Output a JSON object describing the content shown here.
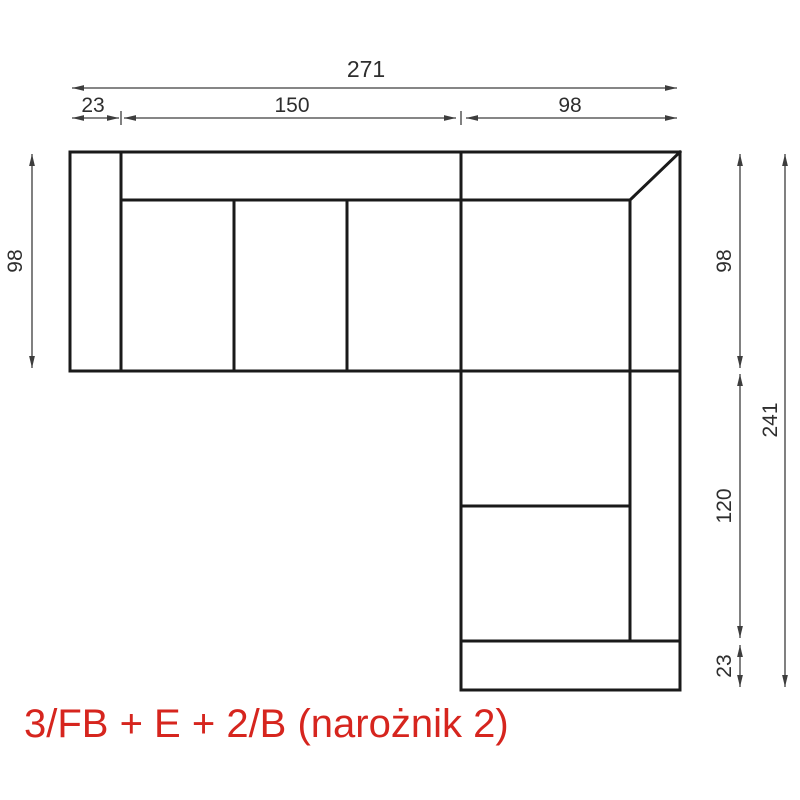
{
  "diagram": {
    "kind": "corner-sofa-technical-drawing",
    "caption": {
      "text": "3/FB + E + 2/B (narożnik 2)",
      "color": "#d6251e"
    },
    "colors": {
      "outline": "#1a1a1a",
      "dimension_lines": "#3d3d3d",
      "background": "#ffffff"
    },
    "dimensions": {
      "top_total": "271",
      "top_armrest": "23",
      "top_seats": "150",
      "top_corner": "98",
      "left_depth": "98",
      "right_corner_depth": "98",
      "right_chaise": "120",
      "right_armrest": "23",
      "right_total": "241"
    }
  }
}
